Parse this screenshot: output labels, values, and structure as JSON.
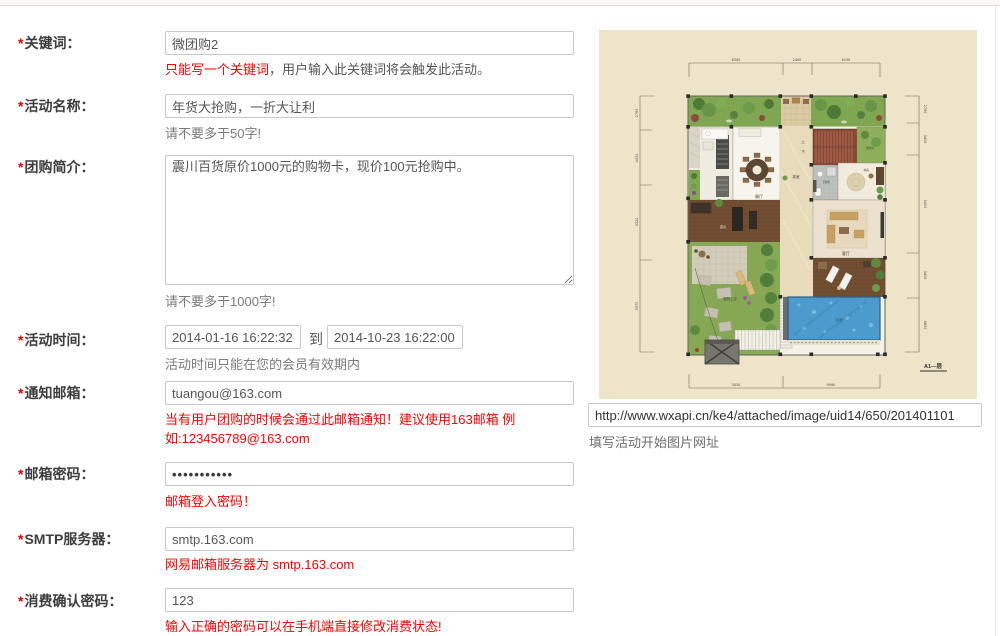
{
  "ui": {
    "asterisk": "*",
    "to_label": "到"
  },
  "form": {
    "keyword": {
      "label": "关键词：",
      "value": "微团购2",
      "hint_red": "只能写一个关键词",
      "hint_dark": "，用户输入此关键词将会触发此活动。"
    },
    "name": {
      "label": "活动名称：",
      "value": "年货大抢购，一折大让利",
      "hint_gray": "请不要多于50字!"
    },
    "intro": {
      "label": "团购简介：",
      "value": "震川百货原价1000元的购物卡，现价100元抢购中。",
      "hint_gray": "请不要多于1000字!"
    },
    "time": {
      "label": "活动时间：",
      "start": "2014-01-16 16:22:32",
      "end": "2014-10-23 16:22:00",
      "hint_gray": "活动时间只能在您的会员有效期内"
    },
    "email": {
      "label": "通知邮箱：",
      "value": "tuangou@163.com",
      "hint_red": "当有用户团购的时候会通过此邮箱通知！建议使用163邮箱 例如:123456789@163.com"
    },
    "password": {
      "label": "邮箱密码：",
      "value": "•••••••••••",
      "hint_red": "邮箱登入密码！"
    },
    "smtp": {
      "label": "SMTP服务器：",
      "value": "smtp.163.com",
      "hint_red": "网易邮箱服务器为 smtp.163.com"
    },
    "confirm": {
      "label": "消费确认密码：",
      "value": "123",
      "hint_red": "输入正确的密码可以在手机端直接修改消费状态!"
    }
  },
  "image": {
    "url_value": "http://www.wxapi.cn/ke4/attached/image/uid14/650/201401101",
    "caption": "填写活动开始图片网址",
    "floor_plan": {
      "title": "A1—层",
      "dims_top": [
        "8240",
        "2400",
        "6100"
      ],
      "dims_left": [
        "2790",
        "4000",
        "3320",
        "5970"
      ],
      "dims_right": [
        "2790",
        "3400",
        "5400",
        "3400",
        "4600"
      ],
      "dims_bottom": [
        "3030",
        "9590"
      ],
      "rooms": {
        "dining": "餐厅",
        "tea": "茶室",
        "bath": "卫生间",
        "study": "书房",
        "living": "客厅",
        "deck": "露台",
        "courtyard": "庭院上空",
        "pool": "泳池",
        "stairwell": "楼梯间",
        "up": "上",
        "down": "下"
      }
    }
  },
  "colors": {
    "accent_red": "#ff0000",
    "panel_cream": "#EDE4C9",
    "label_gray": "#3d3d3d"
  }
}
